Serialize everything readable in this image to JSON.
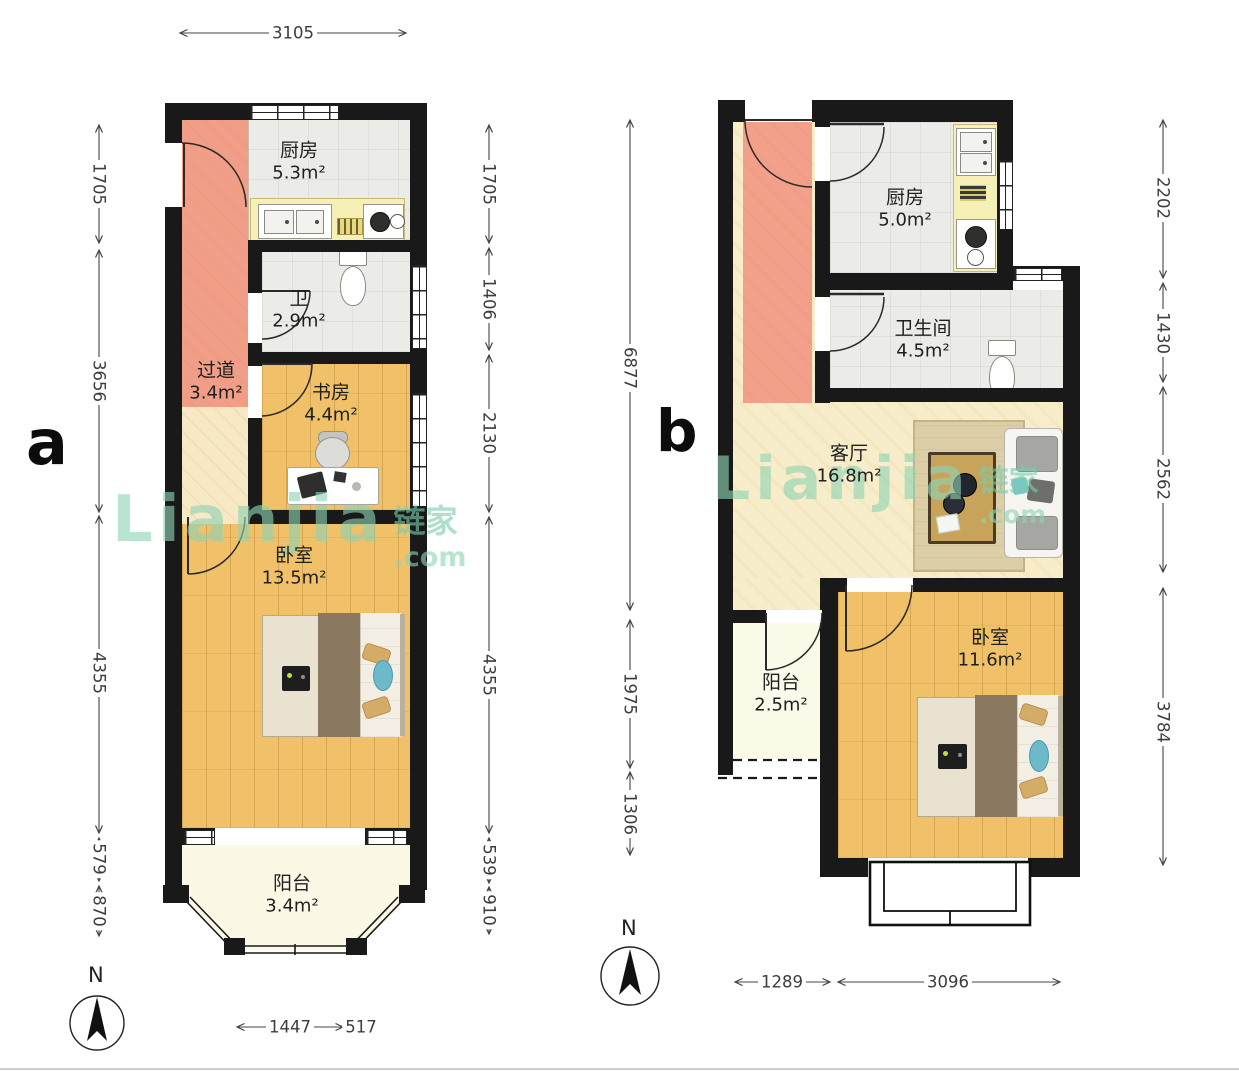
{
  "watermark": {
    "brand": "Lianjia",
    "brand_cn": "链家",
    "domain": ".com"
  },
  "compass": {
    "label": "N"
  },
  "plan_a": {
    "label": "a",
    "rooms": {
      "kitchen": {
        "name": "厨房",
        "area": "5.3m²"
      },
      "bath": {
        "name": "卫",
        "area": "2.9m²"
      },
      "hall": {
        "name": "过道",
        "area": "3.4m²"
      },
      "study": {
        "name": "书房",
        "area": "4.4m²"
      },
      "bedroom": {
        "name": "卧室",
        "area": "13.5m²"
      },
      "balcony": {
        "name": "阳台",
        "area": "3.4m²"
      }
    },
    "dims": {
      "top": "3105",
      "left": [
        "1705",
        "3656",
        "4355",
        "579",
        "870"
      ],
      "right": [
        "1705",
        "1406",
        "2130",
        "4355",
        "539",
        "910"
      ],
      "bottom": [
        "1447",
        "517"
      ]
    }
  },
  "plan_b": {
    "label": "b",
    "rooms": {
      "kitchen": {
        "name": "厨房",
        "area": "5.0m²"
      },
      "bath": {
        "name": "卫生间",
        "area": "4.5m²"
      },
      "living": {
        "name": "客厅",
        "area": "16.8m²"
      },
      "balcony": {
        "name": "阳台",
        "area": "2.5m²"
      },
      "bedroom": {
        "name": "卧室",
        "area": "11.6m²"
      }
    },
    "dims": {
      "left": [
        "6877",
        "1975",
        "1306"
      ],
      "right": [
        "2202",
        "1430",
        "2562",
        "3784"
      ],
      "bottom": [
        "1289",
        "3096"
      ]
    }
  }
}
